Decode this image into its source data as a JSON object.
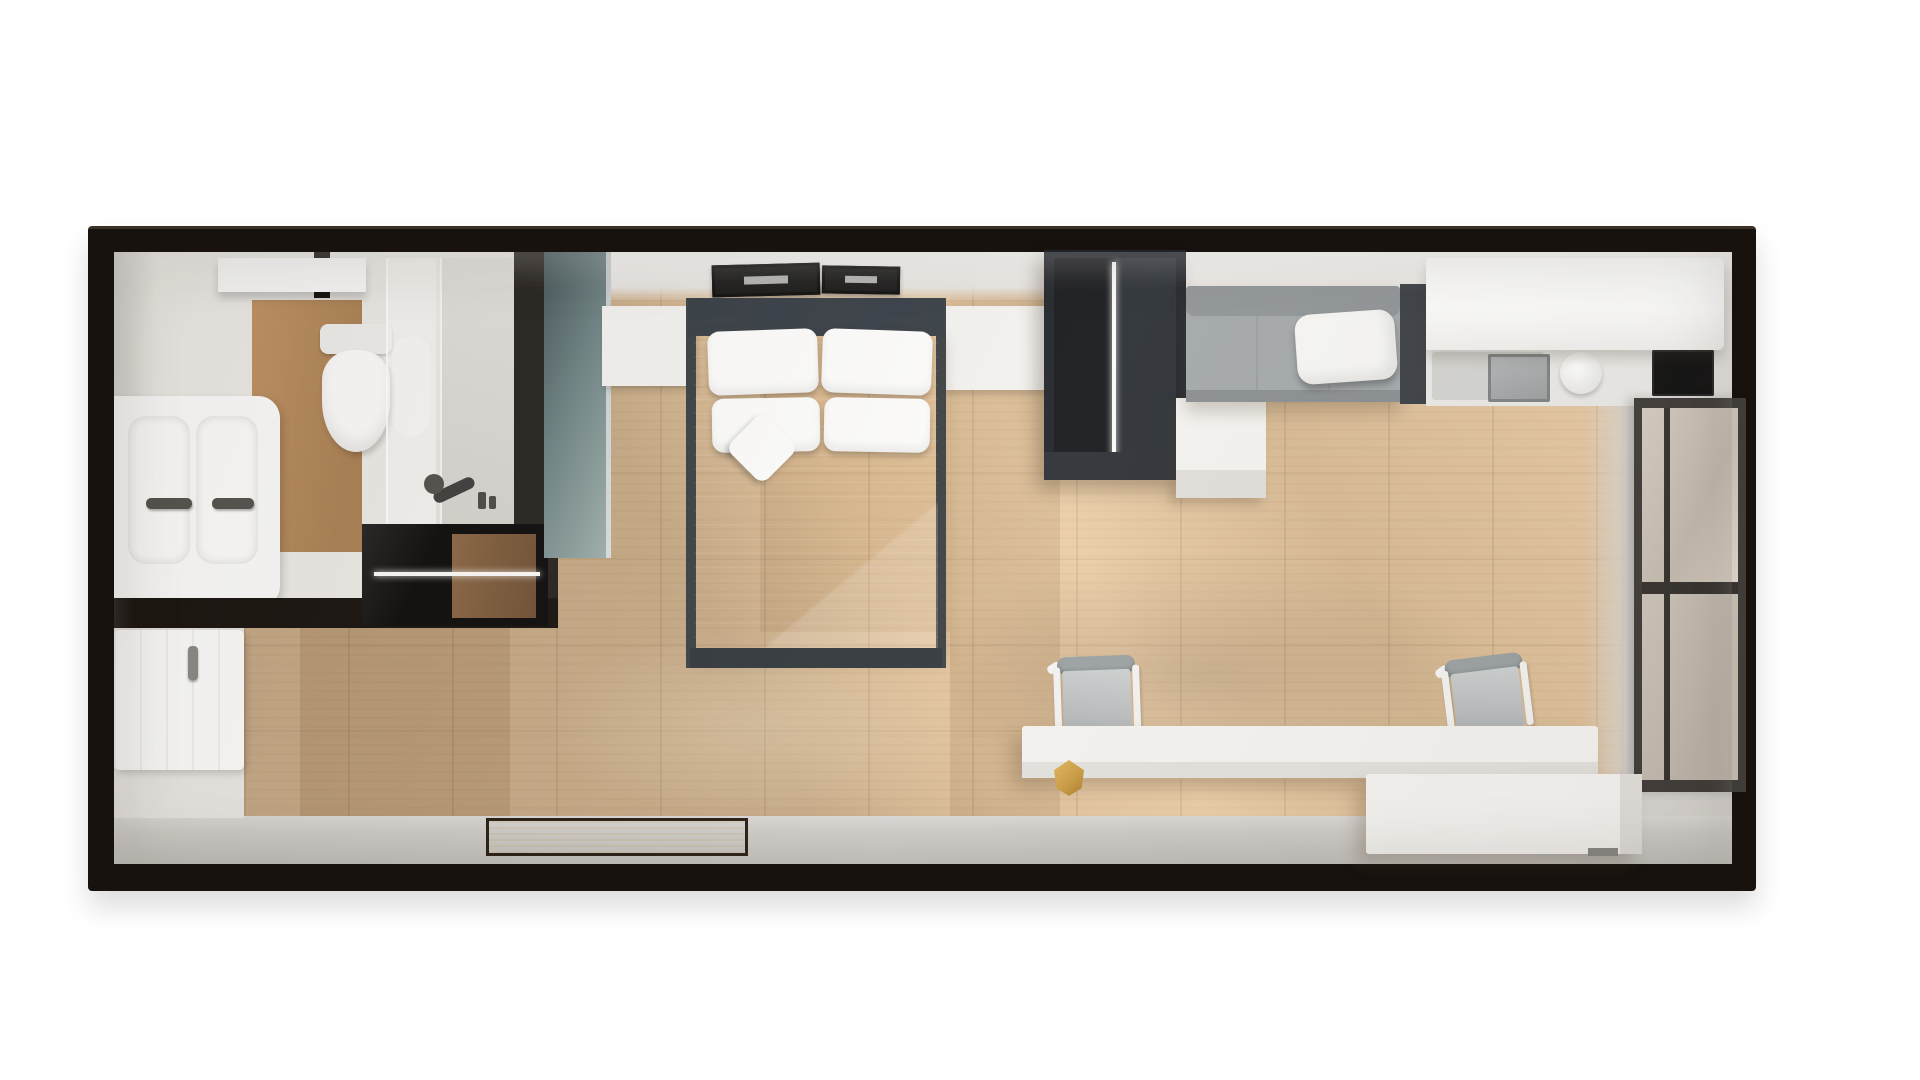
{
  "scene": {
    "description": "Top-down 3D architectural render of a narrow studio apartment on a white background",
    "style": "photoreal top-down render, no text labels visible",
    "rooms": [
      "bathroom",
      "entry-hall",
      "sleeping-area",
      "living-area",
      "kitchenette",
      "walkway-strip"
    ],
    "furniture": [
      {
        "name": "double-sink-vanity",
        "room": "bathroom",
        "color": "white",
        "details": "two basins, two dark faucets"
      },
      {
        "name": "toilet",
        "room": "bathroom",
        "color": "white"
      },
      {
        "name": "wall-shelf",
        "room": "bathroom",
        "color": "white"
      },
      {
        "name": "walk-in-shower",
        "room": "bathroom",
        "details": "glass partition, dark wall fixture, bottles"
      },
      {
        "name": "recessed-shelf-unit",
        "room": "entry-hall",
        "color": "black",
        "details": "wood back panel, white LED strip"
      },
      {
        "name": "entry-door",
        "room": "entry-hall",
        "color": "white",
        "details": "vertical grooves, gray handle"
      },
      {
        "name": "double-bed",
        "room": "sleeping-area",
        "details": "charcoal frame, gray duvet, 4 white pillows, 1 diamond accent pillow"
      },
      {
        "name": "nightstand",
        "room": "sleeping-area",
        "count": 2,
        "color": "white"
      },
      {
        "name": "wall-art-frame",
        "room": "sleeping-area",
        "count": 2,
        "color": "black"
      },
      {
        "name": "open-wardrobe",
        "room": "sleeping-area",
        "color": "charcoal",
        "details": "center divider with lit seam"
      },
      {
        "name": "ottoman-box",
        "room": "living-area",
        "color": "white"
      },
      {
        "name": "sofa",
        "room": "living-area",
        "color": "gray",
        "details": "white throw pillow, dark side table"
      },
      {
        "name": "kitchen-upper-cabinet",
        "room": "kitchenette",
        "color": "white"
      },
      {
        "name": "kitchen-countertop",
        "room": "kitchenette",
        "details": "sink, round faucet, black cooktop"
      },
      {
        "name": "window",
        "room": "living-area",
        "details": "two beige glass panes, dark frame, right wall"
      },
      {
        "name": "desk",
        "room": "living-area",
        "color": "white"
      },
      {
        "name": "desk-chair",
        "room": "living-area",
        "count": 2,
        "details": "gray seat, white frame"
      },
      {
        "name": "gold-vase",
        "room": "living-area",
        "color": "brass"
      },
      {
        "name": "storage-bench",
        "room": "living-area",
        "color": "white"
      },
      {
        "name": "doormat",
        "room": "walkway-strip",
        "color": "dark-brown"
      }
    ],
    "floor": "light oak plank flooring with diagonal sunlight shadows",
    "walls": "black outer walls, white inner walls, sage-green partition, dark bathroom partition"
  },
  "palette": {
    "bg": "#ffffff",
    "wallFrame": "#17120e",
    "interiorBase": "#e6e4e1",
    "topWall": "#f6f5f3",
    "wood": "#e7c8a0",
    "grayStrip": "#cfcdc9",
    "grayRight": "#d7d4d0",
    "bathBase": "#eceae6",
    "bathWood": "#bf9263",
    "showerGray": "#d8d6d2",
    "darkWall": "#262320",
    "blackUnit": "#0c0b0a",
    "led": "#fafaf8",
    "sageDark": "#45565a",
    "sageLight": "#9db0ad",
    "white": "#f3f2ef",
    "whiteBright": "#fbfbfa",
    "bedFrame": "#363d45",
    "mattressLight": "#b4b7b9",
    "mattressDark": "#8d9195",
    "pillow": "#fcfcfb",
    "wardrobeBody": "#202329",
    "wardrobeInnerL": "#16181c",
    "wardrobeInnerR": "#2a2f35",
    "sofaBody": "#a2a7aa",
    "sofaBack": "#8f9497",
    "sofaSide": "#3a3e43",
    "counter": "#e9e8e5",
    "sinkOuter": "#d2d2cf",
    "sinkBasin": "#9a9ea0",
    "cooktop": "#121212",
    "windowFrame": "#403c39",
    "paneUpper": "#d5ccc1",
    "paneLower": "#ccc4ba",
    "chairBack": "#9aa0a2",
    "chairSeat": "#aeb2b4",
    "gold": "#c9993f",
    "goldDark": "#a87926",
    "mat": "#3f2e1d",
    "matBorder": "#241a0f"
  }
}
